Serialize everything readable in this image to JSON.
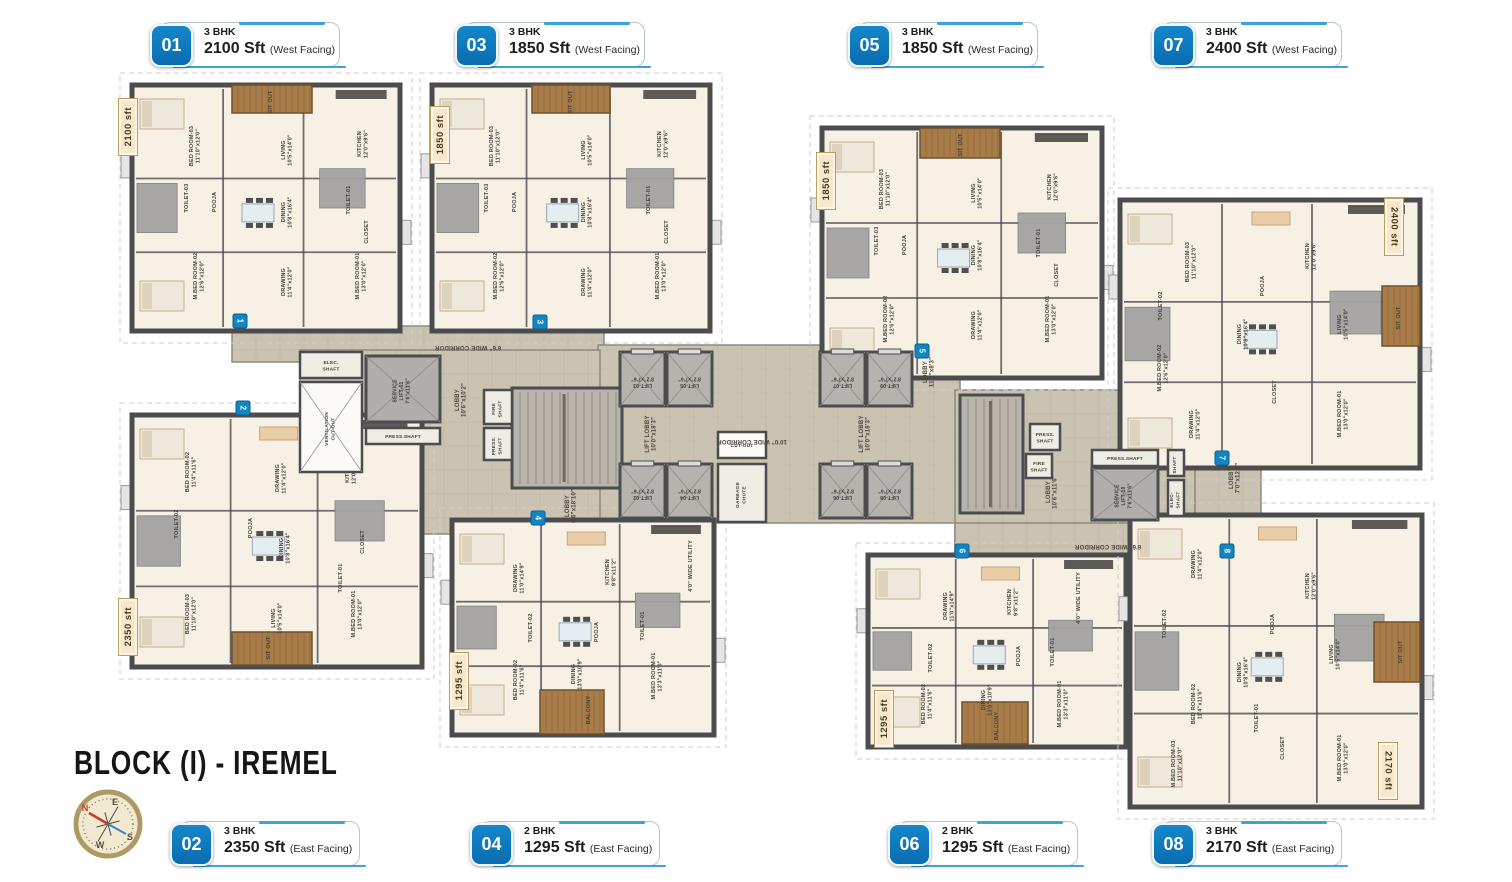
{
  "title": "BLOCK (I) - IREMEL",
  "compass": {
    "n": "N",
    "e": "E",
    "s": "S",
    "w": "W"
  },
  "colors": {
    "accent_blue": "#0d74ba",
    "line_blue": "#3aa3d9",
    "wall": "#4c4c4e",
    "floor": "#f7f1e5",
    "corridor": "#cac3b2",
    "wood": "#a87c48",
    "tile": "#a4a3a2",
    "tag_bg": "#f6e8cd",
    "tag_border": "#bf9c62"
  },
  "callouts": [
    {
      "num": "01",
      "bhk": "3 BHK",
      "area": "2100 Sft",
      "facing": "(West Facing)",
      "x": 150,
      "y": 21
    },
    {
      "num": "03",
      "bhk": "3 BHK",
      "area": "1850 Sft",
      "facing": "(West Facing)",
      "x": 455,
      "y": 21
    },
    {
      "num": "05",
      "bhk": "3 BHK",
      "area": "1850 Sft",
      "facing": "(West Facing)",
      "x": 848,
      "y": 21
    },
    {
      "num": "07",
      "bhk": "3 BHK",
      "area": "2400 Sft",
      "facing": "(West Facing)",
      "x": 1152,
      "y": 21
    },
    {
      "num": "02",
      "bhk": "3 BHK",
      "area": "2350 Sft",
      "facing": "(East Facing)",
      "x": 170,
      "y": 820
    },
    {
      "num": "04",
      "bhk": "2 BHK",
      "area": "1295 Sft",
      "facing": "(East Facing)",
      "x": 470,
      "y": 820
    },
    {
      "num": "06",
      "bhk": "2 BHK",
      "area": "1295 Sft",
      "facing": "(East Facing)",
      "x": 888,
      "y": 820
    },
    {
      "num": "08",
      "bhk": "3 BHK",
      "area": "2170 Sft",
      "facing": "(East Facing)",
      "x": 1152,
      "y": 820
    }
  ],
  "area_tags": [
    {
      "text": "2100 sft",
      "x": 118,
      "y": 98,
      "side": "left"
    },
    {
      "text": "1850 sft",
      "x": 430,
      "y": 106,
      "side": "left"
    },
    {
      "text": "1850 sft",
      "x": 816,
      "y": 152,
      "side": "left"
    },
    {
      "text": "2400 sft",
      "x": 1384,
      "y": 198,
      "side": "right"
    },
    {
      "text": "2350 sft",
      "x": 118,
      "y": 598,
      "side": "left"
    },
    {
      "text": "1295 sft",
      "x": 449,
      "y": 652,
      "side": "left"
    },
    {
      "text": "1295 sft",
      "x": 874,
      "y": 690,
      "side": "left"
    },
    {
      "text": "2170 sft",
      "x": 1378,
      "y": 742,
      "side": "right"
    }
  ],
  "plan": {
    "corridor_segments": [
      [
        232,
        326,
        372,
        36
      ],
      [
        598,
        345,
        362,
        178
      ],
      [
        300,
        350,
        300,
        184
      ],
      [
        955,
        390,
        240,
        172
      ],
      [
        955,
        523,
        340,
        38
      ],
      [
        1195,
        428,
        66,
        98
      ]
    ],
    "corridor_labels": [
      {
        "t": "6'6\" WIDE CORRIDOR",
        "x": 468,
        "y": 346,
        "r": 180
      },
      {
        "t": "10'0\" WIDE CORRIDOR",
        "x": 752,
        "y": 440,
        "r": 180
      },
      {
        "t": "6'6\" WIDE CORRIDOR",
        "x": 1108,
        "y": 545,
        "r": 180
      },
      {
        "t": "LIFT LOBBY\n10'0\"x18'3\"",
        "x": 652,
        "y": 434,
        "r": -90
      },
      {
        "t": "LIFT LOBBY\n10'0\"x18'3\"",
        "x": 866,
        "y": 434,
        "r": -90
      },
      {
        "t": "LOBBY\n10'6\"x10'2\"",
        "x": 462,
        "y": 400,
        "r": -90
      },
      {
        "t": "LOBBY\n6'6\"x18'10\"",
        "x": 572,
        "y": 506,
        "r": -90
      },
      {
        "t": "LOBBY\n11'2\"x8'3\"",
        "x": 930,
        "y": 372,
        "r": -90
      },
      {
        "t": "LOBBY\n10'6\"x11'6\"",
        "x": 1053,
        "y": 492,
        "r": -90
      },
      {
        "t": "LOBBY\n7'0\"x12'9\"",
        "x": 1236,
        "y": 478,
        "r": -90
      }
    ],
    "lifts": [
      {
        "t": "LIFT-03\n8'2\"x7'6\"",
        "x": 620,
        "y": 352,
        "w": 45,
        "h": 54
      },
      {
        "t": "LIFT-05\n8'2\"x7'6\"",
        "x": 667,
        "y": 352,
        "w": 45,
        "h": 54
      },
      {
        "t": "LIFT-07\n8'2\"x7'6\"",
        "x": 820,
        "y": 352,
        "w": 45,
        "h": 54
      },
      {
        "t": "LIFT-09\n8'2\"x7'6\"",
        "x": 867,
        "y": 352,
        "w": 45,
        "h": 54
      },
      {
        "t": "LIFT-02\n8'2\"x7'6\"",
        "x": 620,
        "y": 464,
        "w": 45,
        "h": 54
      },
      {
        "t": "LIFT-04\n8'2\"x7'6\"",
        "x": 667,
        "y": 464,
        "w": 45,
        "h": 54
      },
      {
        "t": "LIFT-06\n8'2\"x7'6\"",
        "x": 820,
        "y": 464,
        "w": 45,
        "h": 54
      },
      {
        "t": "LIFT-08\n8'2\"x7'6\"",
        "x": 867,
        "y": 464,
        "w": 45,
        "h": 54
      }
    ],
    "service_lifts": [
      {
        "t": "SERVICE\nLIFT-01\n7'6\"x11'6\"",
        "x": 366,
        "y": 356,
        "w": 74,
        "h": 66
      },
      {
        "t": "SERVICE\nLIFT-10\n7'6\"x11'6\"",
        "x": 1092,
        "y": 468,
        "w": 66,
        "h": 52
      }
    ],
    "stairs": [
      [
        512,
        388,
        110,
        100
      ],
      [
        960,
        395,
        63,
        118
      ]
    ],
    "shafts": [
      {
        "t": "ELEC.\nSHAFT",
        "x": 300,
        "y": 352,
        "w": 62,
        "h": 26
      },
      {
        "t": "VENTILATION\nCUT-OUT",
        "x": 300,
        "y": 382,
        "w": 62,
        "h": 90,
        "cross": true,
        "light": true,
        "r": -90
      },
      {
        "t": "PRESS.SHAFT",
        "x": 366,
        "y": 428,
        "w": 74,
        "h": 16
      },
      {
        "t": "FIRE\nSHAFT",
        "x": 484,
        "y": 390,
        "w": 28,
        "h": 34,
        "r": -90
      },
      {
        "t": "PRESS.\nSHAFT",
        "x": 484,
        "y": 428,
        "w": 28,
        "h": 32,
        "r": -90
      },
      {
        "t": "PRESS.\nSHAFT",
        "x": 1030,
        "y": 424,
        "w": 30,
        "h": 26
      },
      {
        "t": "FIRE\nSHAFT",
        "x": 1026,
        "y": 454,
        "w": 26,
        "h": 24
      },
      {
        "t": "PRESS.SHAFT",
        "x": 1092,
        "y": 450,
        "w": 66,
        "h": 16
      },
      {
        "t": "SHAFT",
        "x": 1168,
        "y": 450,
        "w": 16,
        "h": 26,
        "r": -90
      },
      {
        "t": "ELEC-\nSHAFT",
        "x": 1168,
        "y": 480,
        "w": 16,
        "h": 36,
        "r": -90
      },
      {
        "t": "CUT-OUT",
        "x": 718,
        "y": 432,
        "w": 48,
        "h": 26,
        "light": true
      },
      {
        "t": "GARBAGE\nCHUTE",
        "x": 718,
        "y": 464,
        "w": 48,
        "h": 58,
        "r": -90
      }
    ],
    "markers": [
      {
        "n": "1",
        "x": 240,
        "y": 321
      },
      {
        "n": "2",
        "x": 243,
        "y": 408
      },
      {
        "n": "3",
        "x": 540,
        "y": 322
      },
      {
        "n": "4",
        "x": 538,
        "y": 518
      },
      {
        "n": "5",
        "x": 922,
        "y": 351
      },
      {
        "n": "6",
        "x": 962,
        "y": 551
      },
      {
        "n": "7",
        "x": 1222,
        "y": 458
      },
      {
        "n": "8",
        "x": 1227,
        "y": 551
      }
    ],
    "clusters": [
      {
        "unit": "01",
        "x": 132,
        "y": 85,
        "w": 268,
        "h": 246,
        "wood": [
          [
            232,
            85,
            80,
            28
          ]
        ],
        "labels": [
          {
            "t": "SIT OUT",
            "x": 272,
            "y": 102
          },
          {
            "t": "BED ROOM-03\n11'10\"x12'0\"",
            "x": 196,
            "y": 146
          },
          {
            "t": "LIVING\n10'5\"x14'0\"",
            "x": 288,
            "y": 150
          },
          {
            "t": "KITCHEN\n12'0\"x9'6\"",
            "x": 364,
            "y": 144
          },
          {
            "t": "TOILET-03",
            "x": 188,
            "y": 198
          },
          {
            "t": "POOJA",
            "x": 216,
            "y": 202
          },
          {
            "t": "DINING\n10'8\"x16'4\"",
            "x": 288,
            "y": 212
          },
          {
            "t": "TOILET-01",
            "x": 350,
            "y": 200
          },
          {
            "t": "CLOSET",
            "x": 368,
            "y": 232
          },
          {
            "t": "M.BED ROOM-02\n12'6\"x12'0\"",
            "x": 200,
            "y": 276
          },
          {
            "t": "DRAWING\n11'4\"x12'0\"",
            "x": 288,
            "y": 282
          },
          {
            "t": "M.BED ROOM-01\n13'0\"x12'0\"",
            "x": 362,
            "y": 276
          }
        ]
      },
      {
        "unit": "03",
        "x": 432,
        "y": 85,
        "w": 278,
        "h": 246,
        "wood": [
          [
            532,
            85,
            78,
            28
          ]
        ],
        "labels": [
          {
            "t": "SIT OUT",
            "x": 572,
            "y": 102
          },
          {
            "t": "BED ROOM-03\n11'10\"x12'0\"",
            "x": 496,
            "y": 146
          },
          {
            "t": "LIVING\n10'5\"x14'0\"",
            "x": 588,
            "y": 150
          },
          {
            "t": "KITCHEN\n12'0\"x9'6\"",
            "x": 664,
            "y": 144
          },
          {
            "t": "TOILET-03",
            "x": 488,
            "y": 198
          },
          {
            "t": "POOJA",
            "x": 516,
            "y": 202
          },
          {
            "t": "DINING\n10'8\"x16'4\"",
            "x": 588,
            "y": 212
          },
          {
            "t": "TOILET-01",
            "x": 650,
            "y": 200
          },
          {
            "t": "CLOSET",
            "x": 668,
            "y": 232
          },
          {
            "t": "M.BED ROOM-02\n12'6\"x12'0\"",
            "x": 500,
            "y": 276
          },
          {
            "t": "DRAWING\n11'4\"x12'0\"",
            "x": 588,
            "y": 282
          },
          {
            "t": "M.BED ROOM-01\n13'0\"x12'0\"",
            "x": 662,
            "y": 276
          }
        ]
      },
      {
        "unit": "05",
        "x": 822,
        "y": 128,
        "w": 280,
        "h": 250,
        "wood": [
          [
            920,
            128,
            80,
            30
          ]
        ],
        "labels": [
          {
            "t": "SIT OUT",
            "x": 962,
            "y": 145
          },
          {
            "t": "BED ROOM-03\n11'10\"x12'0\"",
            "x": 886,
            "y": 189
          },
          {
            "t": "LIVING\n10'5\"x14'0\"",
            "x": 978,
            "y": 193
          },
          {
            "t": "KITCHEN\n12'0\"x9'6\"",
            "x": 1054,
            "y": 187
          },
          {
            "t": "TOILET-03",
            "x": 878,
            "y": 241
          },
          {
            "t": "POOJA",
            "x": 906,
            "y": 245
          },
          {
            "t": "DINING\n10'8\"x16'4\"",
            "x": 978,
            "y": 255
          },
          {
            "t": "TOILET-01",
            "x": 1040,
            "y": 243
          },
          {
            "t": "CLOSET",
            "x": 1058,
            "y": 275
          },
          {
            "t": "M.BED ROOM-02\n12'6\"x12'0\"",
            "x": 890,
            "y": 319
          },
          {
            "t": "DRAWING\n11'4\"x12'0\"",
            "x": 978,
            "y": 325
          },
          {
            "t": "M.BED ROOM-01\n13'0\"x12'0\"",
            "x": 1052,
            "y": 319
          }
        ]
      },
      {
        "unit": "07",
        "x": 1120,
        "y": 200,
        "w": 300,
        "h": 268,
        "wood": [
          [
            1382,
            286,
            38,
            60
          ]
        ],
        "labels": [
          {
            "t": "BED ROOM-03\n11'10\"x12'0\"",
            "x": 1192,
            "y": 262
          },
          {
            "t": "KITCHEN\n12'0\"x9'6\"",
            "x": 1312,
            "y": 256
          },
          {
            "t": "POOJA",
            "x": 1264,
            "y": 286
          },
          {
            "t": "LIVING\n10'5\"x14'0\"",
            "x": 1344,
            "y": 324
          },
          {
            "t": "DINING\n10'8\"x16'4\"",
            "x": 1244,
            "y": 334
          },
          {
            "t": "TOILET-02",
            "x": 1162,
            "y": 306
          },
          {
            "t": "M.BED ROOM-02\n12'6\"x12'0\"",
            "x": 1164,
            "y": 368
          },
          {
            "t": "DRAWING\n11'4\"x12'0\"",
            "x": 1196,
            "y": 424
          },
          {
            "t": "CLOSET",
            "x": 1276,
            "y": 392
          },
          {
            "t": "M.BED ROOM-01\n13'0\"x12'0\"",
            "x": 1344,
            "y": 414
          },
          {
            "t": "SIT OUT",
            "x": 1400,
            "y": 318
          }
        ]
      },
      {
        "unit": "02",
        "x": 132,
        "y": 415,
        "w": 290,
        "h": 252,
        "wood": [
          [
            232,
            632,
            80,
            33
          ]
        ],
        "labels": [
          {
            "t": "BED ROOM-02\n11'4\"x11'6\"",
            "x": 192,
            "y": 472
          },
          {
            "t": "DRAWING\n11'4\"x12'0\"",
            "x": 282,
            "y": 478
          },
          {
            "t": "KITCHEN\n12'0\"x9'6\"",
            "x": 352,
            "y": 470
          },
          {
            "t": "TOILET-02",
            "x": 178,
            "y": 524
          },
          {
            "t": "POOJA",
            "x": 252,
            "y": 528
          },
          {
            "t": "DINING\n10'8\"x16'4\"",
            "x": 286,
            "y": 548
          },
          {
            "t": "CLOSET",
            "x": 364,
            "y": 542
          },
          {
            "t": "TOILET-01",
            "x": 342,
            "y": 578
          },
          {
            "t": "BED ROOM-03\n11'10\"x12'0\"",
            "x": 192,
            "y": 614
          },
          {
            "t": "LIVING\n10'5\"x14'0\"",
            "x": 278,
            "y": 618
          },
          {
            "t": "M.BED ROOM-01\n13'0\"x12'0\"",
            "x": 358,
            "y": 614
          },
          {
            "t": "SIT OUT",
            "x": 270,
            "y": 648
          }
        ]
      },
      {
        "unit": "04",
        "x": 452,
        "y": 520,
        "w": 262,
        "h": 215,
        "wood": [
          [
            540,
            690,
            64,
            44
          ]
        ],
        "labels": [
          {
            "t": "DRAWING\n11'0\"x14'9\"",
            "x": 520,
            "y": 578
          },
          {
            "t": "KITCHEN\n9'8\"x11'2\"",
            "x": 612,
            "y": 572
          },
          {
            "t": "4'0\" WIDE UTILITY",
            "x": 692,
            "y": 566
          },
          {
            "t": "TOILET-02",
            "x": 532,
            "y": 628
          },
          {
            "t": "POOJA",
            "x": 598,
            "y": 632
          },
          {
            "t": "TOILET-01",
            "x": 644,
            "y": 626
          },
          {
            "t": "BED ROOM-02\n11'4\"x11'6\"",
            "x": 520,
            "y": 680
          },
          {
            "t": "DINING\n13'0\"x10'9\"",
            "x": 578,
            "y": 674
          },
          {
            "t": "M.BED ROOM-01\n13'3\"x11'0\"",
            "x": 658,
            "y": 676
          },
          {
            "t": "BALCONY",
            "x": 590,
            "y": 710
          }
        ]
      },
      {
        "unit": "06",
        "x": 868,
        "y": 555,
        "w": 258,
        "h": 192,
        "wood": [
          [
            962,
            702,
            66,
            42
          ]
        ],
        "labels": [
          {
            "t": "DRAWING\n11'0\"x14'9\"",
            "x": 950,
            "y": 606
          },
          {
            "t": "KITCHEN\n9'8\"x11'2\"",
            "x": 1014,
            "y": 602
          },
          {
            "t": "4'0\" WIDE UTILITY",
            "x": 1080,
            "y": 598
          },
          {
            "t": "TOILET-02",
            "x": 932,
            "y": 658
          },
          {
            "t": "POOJA",
            "x": 1020,
            "y": 656
          },
          {
            "t": "TOILET-01",
            "x": 1054,
            "y": 652
          },
          {
            "t": "BED ROOM-02\n11'4\"x11'6\"",
            "x": 928,
            "y": 704
          },
          {
            "t": "DINING\n13'0\"x10'9\"",
            "x": 988,
            "y": 700
          },
          {
            "t": "M.BED ROOM-01\n13'3\"x11'0\"",
            "x": 1064,
            "y": 704
          },
          {
            "t": "BALCONY",
            "x": 998,
            "y": 726
          }
        ]
      },
      {
        "unit": "08",
        "x": 1130,
        "y": 515,
        "w": 292,
        "h": 292,
        "wood": [
          [
            1374,
            622,
            46,
            60
          ]
        ],
        "labels": [
          {
            "t": "DRAWING\n11'4\"x12'0\"",
            "x": 1198,
            "y": 564
          },
          {
            "t": "KITCHEN\n12'0\"x9'6\"",
            "x": 1312,
            "y": 586
          },
          {
            "t": "POOJA",
            "x": 1274,
            "y": 624
          },
          {
            "t": "LIVING\n10'5\"x14'0\"",
            "x": 1336,
            "y": 654
          },
          {
            "t": "DINING\n10'8\"x16'4\"",
            "x": 1244,
            "y": 672
          },
          {
            "t": "TOILET-02",
            "x": 1166,
            "y": 624
          },
          {
            "t": "BED ROOM-02\n11'4\"x11'6\"",
            "x": 1198,
            "y": 704
          },
          {
            "t": "TOILET-01",
            "x": 1258,
            "y": 718
          },
          {
            "t": "CLOSET",
            "x": 1284,
            "y": 748
          },
          {
            "t": "M.BED ROOM-03\n11'10\"x12'0\"",
            "x": 1178,
            "y": 764
          },
          {
            "t": "M.BED ROOM-01\n13'0\"x12'0\"",
            "x": 1344,
            "y": 758
          },
          {
            "t": "SIT OUT",
            "x": 1402,
            "y": 652
          }
        ]
      }
    ]
  }
}
